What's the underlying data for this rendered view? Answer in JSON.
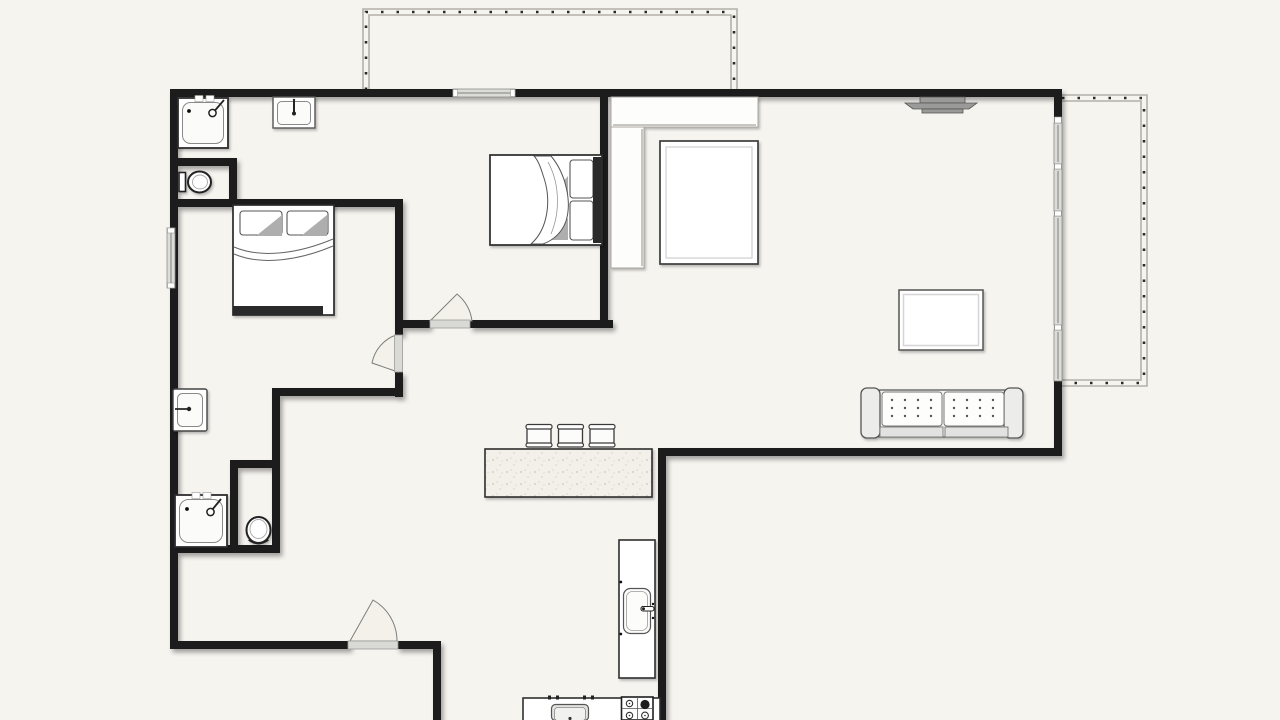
{
  "palette": {
    "background": "#f6f4ef",
    "wall": "#1a1a1a",
    "glass": "#dcdcd9",
    "threshold": "#d9d9d6",
    "railing_line": "#b3b0a9",
    "railing_dash": "#2a2a2a",
    "speckle": "#c9c5b8"
  },
  "floorplan": {
    "type": "apartment-floor-plan",
    "visible_text": "",
    "balconies": 2,
    "door_swings": 3,
    "window_segments": 7,
    "fixtures": [
      "shower-top-bathroom",
      "vanity-sink-top-bathroom",
      "toilet-top-bathroom",
      "wall-sink-lower-bathroom",
      "shower-lower-bathroom",
      "toilet-lower-wc"
    ],
    "furniture": [
      "double-bed-left-bedroom",
      "double-bed-center-bedroom",
      "wardrobe-l-shape",
      "table-living",
      "wall-tv",
      "coffee-table",
      "tufted-sofa",
      "kitchen-island",
      "bar-stool",
      "bar-stool",
      "bar-stool",
      "tall-fridge-unit",
      "kitchen-counter",
      "counter-sink",
      "gas-stove-4-burner"
    ],
    "bar_stools": 3,
    "stove_burners": 4,
    "sofa_cushions": 2
  }
}
